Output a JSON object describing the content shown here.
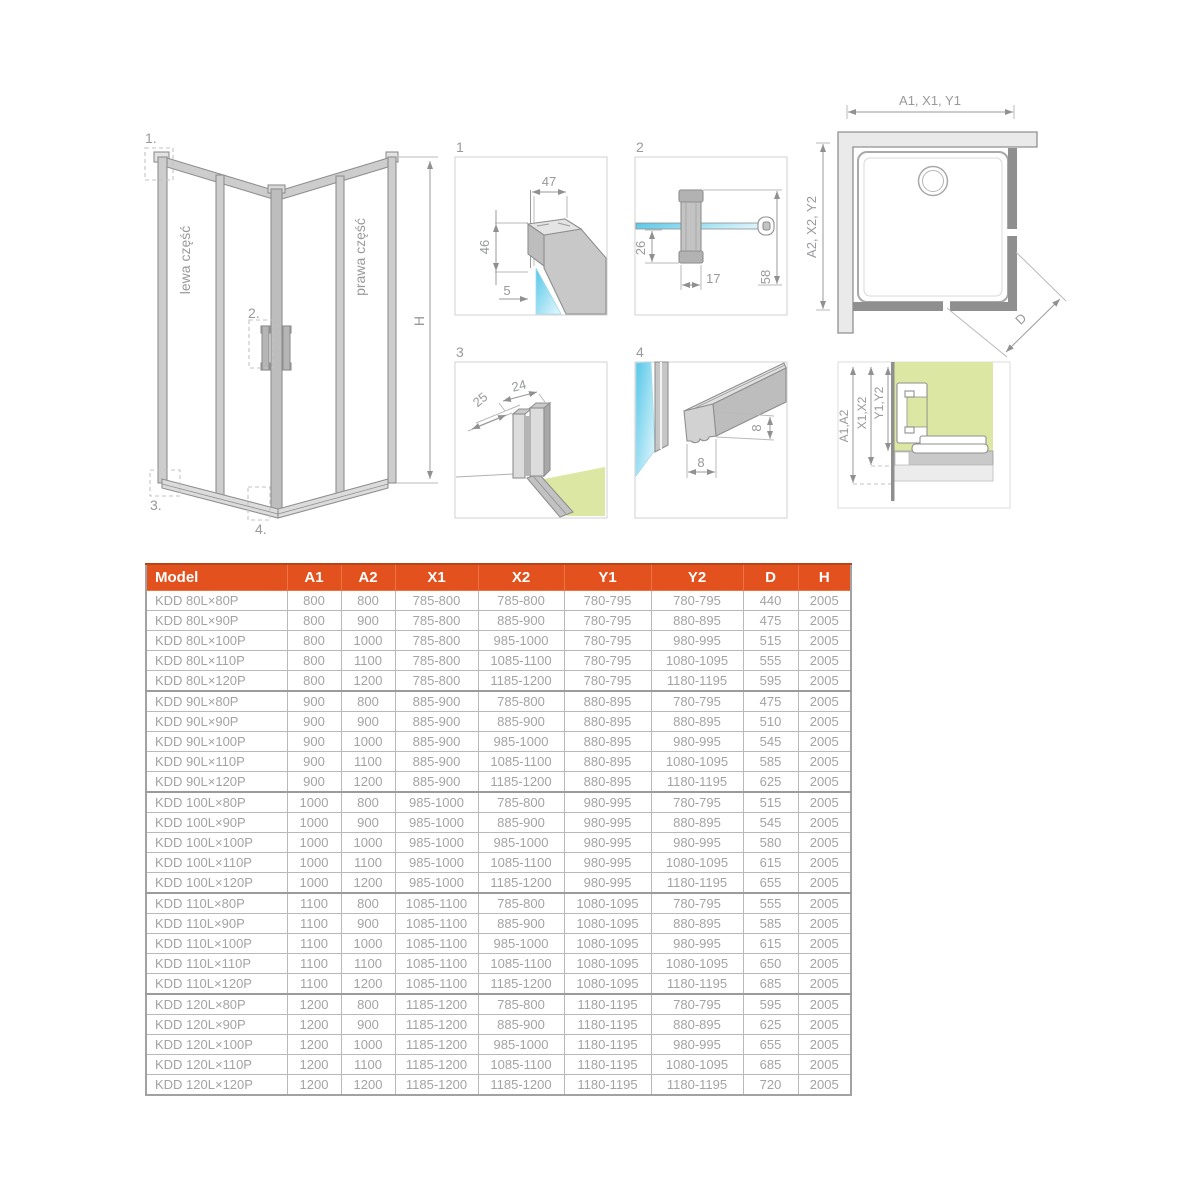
{
  "drawing": {
    "callout_1": "1.",
    "callout_2": "2.",
    "callout_3": "3.",
    "callout_4": "4.",
    "panel_left_label": "lewa część",
    "panel_right_label": "prawa część",
    "height_dim": "H",
    "detail_1": {
      "num": "1",
      "dim_width": "47",
      "dim_height": "46",
      "dim_glass": "5"
    },
    "detail_2": {
      "num": "2",
      "dim_offset": "26",
      "dim_width": "17",
      "dim_height": "58"
    },
    "detail_3": {
      "num": "3",
      "dim_depth": "25",
      "dim_width": "24"
    },
    "detail_4": {
      "num": "4",
      "dim_width": "8",
      "dim_height": "8"
    },
    "plan": {
      "dim_top": "A1, X1, Y1",
      "dim_side": "A2, X2, Y2",
      "dim_diagonal": "D"
    },
    "section": {
      "dim_a": "A1,A2",
      "dim_x": "X1,X2",
      "dim_y": "Y1,Y2"
    }
  },
  "colors": {
    "accent_orange": "#e2511e",
    "glass_blue": "#55c7e8",
    "floor_green": "#dde7a4",
    "line_gray": "#8f8f8f"
  },
  "table": {
    "columns": [
      "Model",
      "A1",
      "A2",
      "X1",
      "X2",
      "Y1",
      "Y2",
      "D",
      "H"
    ],
    "rows": [
      [
        "KDD 80L×80P",
        "800",
        "800",
        "785-800",
        "785-800",
        "780-795",
        "780-795",
        "440",
        "2005"
      ],
      [
        "KDD 80L×90P",
        "800",
        "900",
        "785-800",
        "885-900",
        "780-795",
        "880-895",
        "475",
        "2005"
      ],
      [
        "KDD 80L×100P",
        "800",
        "1000",
        "785-800",
        "985-1000",
        "780-795",
        "980-995",
        "515",
        "2005"
      ],
      [
        "KDD 80L×110P",
        "800",
        "1100",
        "785-800",
        "1085-1100",
        "780-795",
        "1080-1095",
        "555",
        "2005"
      ],
      [
        "KDD 80L×120P",
        "800",
        "1200",
        "785-800",
        "1185-1200",
        "780-795",
        "1180-1195",
        "595",
        "2005"
      ],
      [
        "KDD 90L×80P",
        "900",
        "800",
        "885-900",
        "785-800",
        "880-895",
        "780-795",
        "475",
        "2005"
      ],
      [
        "KDD 90L×90P",
        "900",
        "900",
        "885-900",
        "885-900",
        "880-895",
        "880-895",
        "510",
        "2005"
      ],
      [
        "KDD 90L×100P",
        "900",
        "1000",
        "885-900",
        "985-1000",
        "880-895",
        "980-995",
        "545",
        "2005"
      ],
      [
        "KDD 90L×110P",
        "900",
        "1100",
        "885-900",
        "1085-1100",
        "880-895",
        "1080-1095",
        "585",
        "2005"
      ],
      [
        "KDD 90L×120P",
        "900",
        "1200",
        "885-900",
        "1185-1200",
        "880-895",
        "1180-1195",
        "625",
        "2005"
      ],
      [
        "KDD 100L×80P",
        "1000",
        "800",
        "985-1000",
        "785-800",
        "980-995",
        "780-795",
        "515",
        "2005"
      ],
      [
        "KDD 100L×90P",
        "1000",
        "900",
        "985-1000",
        "885-900",
        "980-995",
        "880-895",
        "545",
        "2005"
      ],
      [
        "KDD 100L×100P",
        "1000",
        "1000",
        "985-1000",
        "985-1000",
        "980-995",
        "980-995",
        "580",
        "2005"
      ],
      [
        "KDD 100L×110P",
        "1000",
        "1100",
        "985-1000",
        "1085-1100",
        "980-995",
        "1080-1095",
        "615",
        "2005"
      ],
      [
        "KDD 100L×120P",
        "1000",
        "1200",
        "985-1000",
        "1185-1200",
        "980-995",
        "1180-1195",
        "655",
        "2005"
      ],
      [
        "KDD 110L×80P",
        "1100",
        "800",
        "1085-1100",
        "785-800",
        "1080-1095",
        "780-795",
        "555",
        "2005"
      ],
      [
        "KDD 110L×90P",
        "1100",
        "900",
        "1085-1100",
        "885-900",
        "1080-1095",
        "880-895",
        "585",
        "2005"
      ],
      [
        "KDD 110L×100P",
        "1100",
        "1000",
        "1085-1100",
        "985-1000",
        "1080-1095",
        "980-995",
        "615",
        "2005"
      ],
      [
        "KDD 110L×110P",
        "1100",
        "1100",
        "1085-1100",
        "1085-1100",
        "1080-1095",
        "1080-1095",
        "650",
        "2005"
      ],
      [
        "KDD 110L×120P",
        "1100",
        "1200",
        "1085-1100",
        "1185-1200",
        "1080-1095",
        "1180-1195",
        "685",
        "2005"
      ],
      [
        "KDD 120L×80P",
        "1200",
        "800",
        "1185-1200",
        "785-800",
        "1180-1195",
        "780-795",
        "595",
        "2005"
      ],
      [
        "KDD 120L×90P",
        "1200",
        "900",
        "1185-1200",
        "885-900",
        "1180-1195",
        "880-895",
        "625",
        "2005"
      ],
      [
        "KDD 120L×100P",
        "1200",
        "1000",
        "1185-1200",
        "985-1000",
        "1180-1195",
        "980-995",
        "655",
        "2005"
      ],
      [
        "KDD 120L×110P",
        "1200",
        "1100",
        "1185-1200",
        "1085-1100",
        "1180-1195",
        "1080-1095",
        "685",
        "2005"
      ],
      [
        "KDD 120L×120P",
        "1200",
        "1200",
        "1185-1200",
        "1185-1200",
        "1180-1195",
        "1180-1195",
        "720",
        "2005"
      ]
    ]
  }
}
